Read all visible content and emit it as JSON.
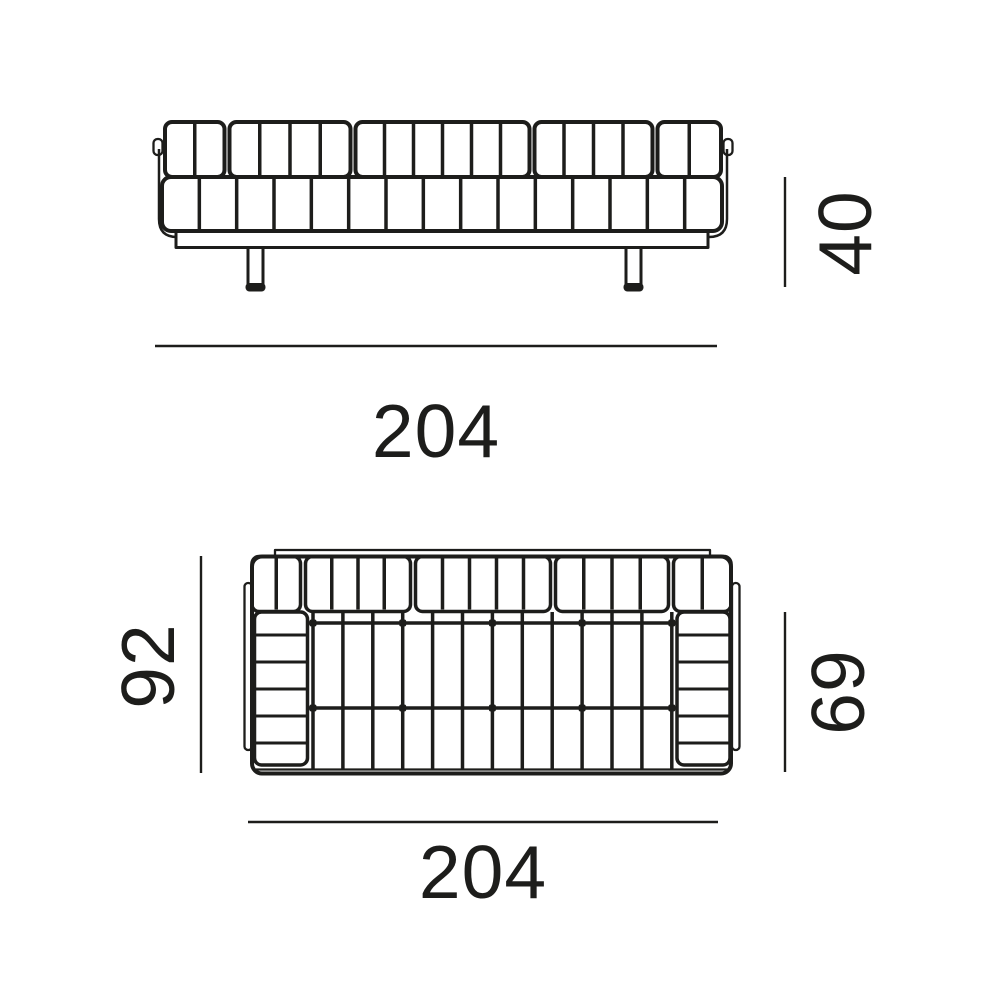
{
  "diagram": {
    "ink_color": "#1d1d1b",
    "background_color": "#ffffff",
    "front_view": {
      "width_label": "204",
      "height_label": "40"
    },
    "plan_view": {
      "width_label": "204",
      "depth_label": "92",
      "seat_depth_label": "69"
    }
  }
}
